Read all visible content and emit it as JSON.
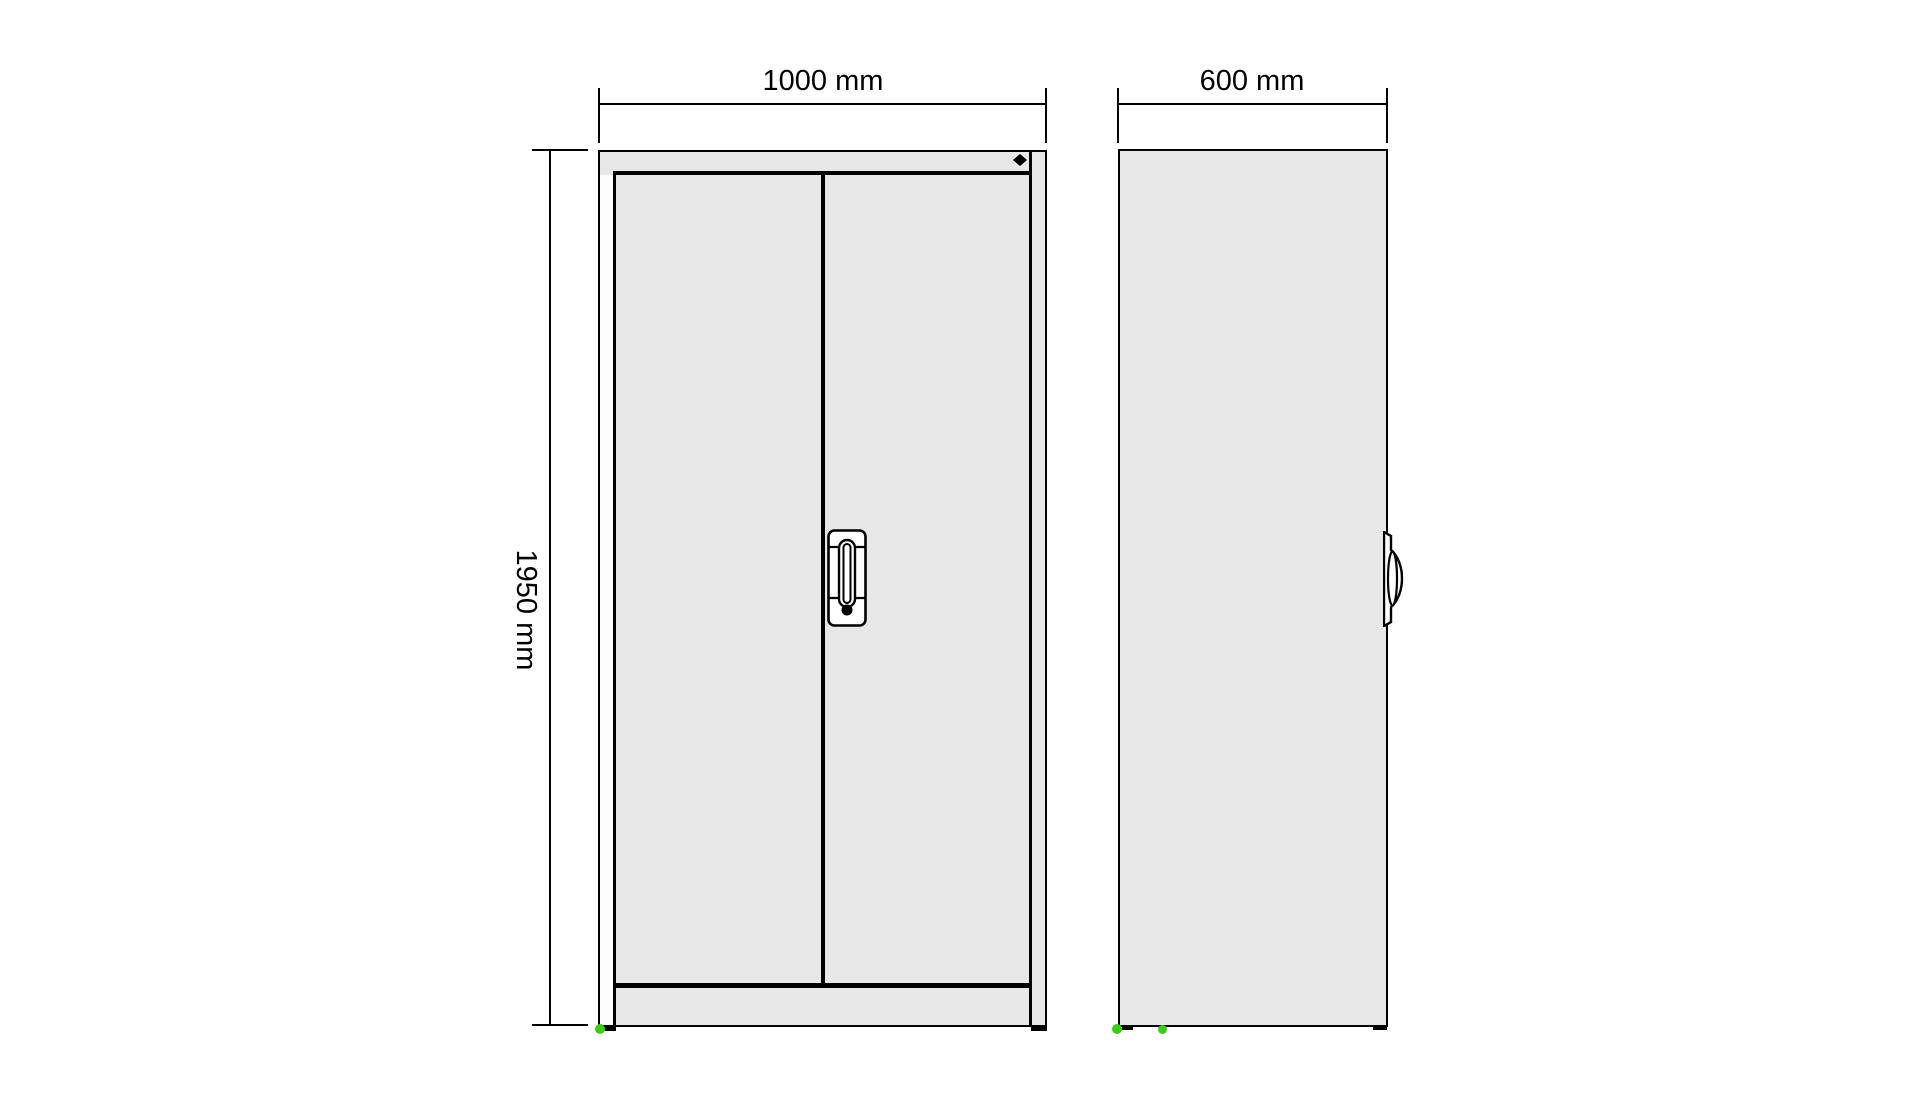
{
  "drawing": {
    "dimensions": {
      "front_width": "1000 mm",
      "front_height": "1950 mm",
      "side_depth": "600 mm"
    },
    "icons": {
      "badge": "diamond-badge-icon",
      "keyhole": "keyhole-icon",
      "feet": "foot-marker"
    },
    "colors": {
      "panel_gray": "#e7e7e7",
      "outline": "#000000",
      "foot_green": "#3bce17",
      "handle_fill": "#ffffff",
      "background": "#ffffff"
    }
  }
}
